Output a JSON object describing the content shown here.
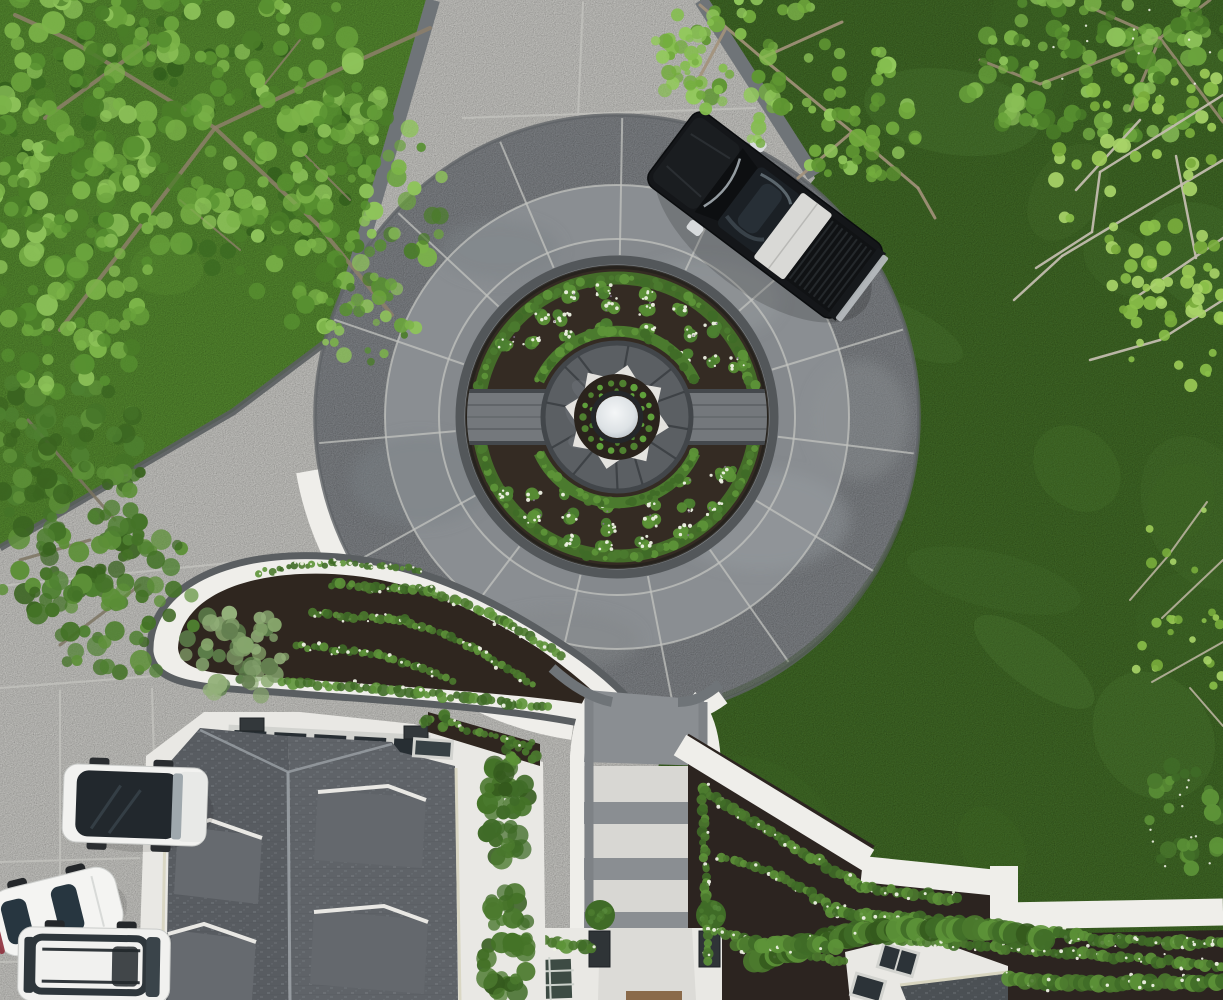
{
  "meta": {
    "type": "aerial-drone-photograph",
    "subject": "luxury estate motor court: circular stamped-concrete driveway around a formal parterre garden with central fountain, front lawn, shingle-roof house, parked vehicles and overhanging trees"
  },
  "colors": {
    "grassDark": "#49742f",
    "grassMid": "#55833a",
    "grassLight": "#5e9739",
    "grassMottleDark": "#3f6a28",
    "concreteLight": "#dcdbd7",
    "concreteJoint": "#c8c8c3",
    "padCurb": "#5a5e61",
    "drivewayGray": "#8d9195",
    "drivewayBandMid": "#8a8e92",
    "drivewayBandInner": "#85898d",
    "drivewayJoint": "#c2c3bf",
    "drivewayEdge": "#6f7478",
    "curbDark": "#53575a",
    "gravelWhite": "#efeeea",
    "soilDark": "#2f261f",
    "mulchDark": "#2c2420",
    "hedgeGreen": "#4b7a2e",
    "hedgeGreenLight": "#5d9338",
    "hedgeGreenDark": "#3f6b27",
    "hedgeDeep": "#345a1d",
    "flowerWhite": "#eef1e4",
    "flowerPurple": "#8a7795",
    "beltStone": "#74787c",
    "beltStoneDark": "#44484c",
    "hubStone": "#5b5f63",
    "hubCrack": "#3a3e42",
    "splashWhite": "#eceae6",
    "fountainRim": "#24272a",
    "waterLight": "#f2f4f5",
    "waterDark": "#bcc3c9",
    "roofWhite": "#e9e8e4",
    "roofShingleL": "#585c61",
    "roofShingleR": "#5f6368",
    "roofDormer": "#666a6f",
    "roofRidge": "#9ba1a6",
    "gutterCream": "#d9d6c1",
    "windowDark": "#2c3338",
    "glassGreen": "#3d4b44",
    "frameLight": "#d2d3cf",
    "truckBlack": "#141619",
    "truckGlass": "#1b2025",
    "truckReflect": "#55626b",
    "truckBedCover": "#d9d9d6",
    "truckBed": "#101214",
    "chrome": "#b9bdc0",
    "vanWhite": "#f2f2f0",
    "vanGlass": "#22282d",
    "carWhite": "#f4f4f2",
    "carGlass": "#273640",
    "tailRed": "#8e2f3c",
    "pineGreen": "#7cb449",
    "pineDark": "#4a7d28",
    "limeGreen": "#9ccb57",
    "branchBrown": "#8d7f6a",
    "branchPale": "#c2bcae",
    "shrubGray": "#7f9c68",
    "pedestalDark": "#2f3437",
    "matBrown": "#8a6a4a"
  },
  "scene": {
    "vehicles": [
      {
        "label": "black-pickup-truck",
        "location": "parked on circular driveway, angled, bed partly covered by silver tonneau"
      },
      {
        "label": "white-van-black-glass-roof",
        "location": "parked on side pad left of house"
      },
      {
        "label": "white-sports-car",
        "location": "parked on side pad, angled, red tail accent"
      },
      {
        "label": "white-suv-roof-rails",
        "location": "parked on side pad bottom left"
      }
    ],
    "landscape_features": [
      "circular-stamped-concrete-motor-court",
      "central-mirror-fountain-with-plant-ring",
      "boxwood-parterre-with-white-annuals",
      "dark-stone-belt-through-garden",
      "teardrop-garden-island",
      "white-gravel-borders",
      "ladder-patterned-entry-walk",
      "dark-shingle-roof-with-dormers",
      "glass-entry-canopy",
      "stepped-white-gravel-path-by-lawn",
      "flower-hedge-rows",
      "overhanging-pine-and-spring-trees",
      "large-back-lawn"
    ]
  }
}
